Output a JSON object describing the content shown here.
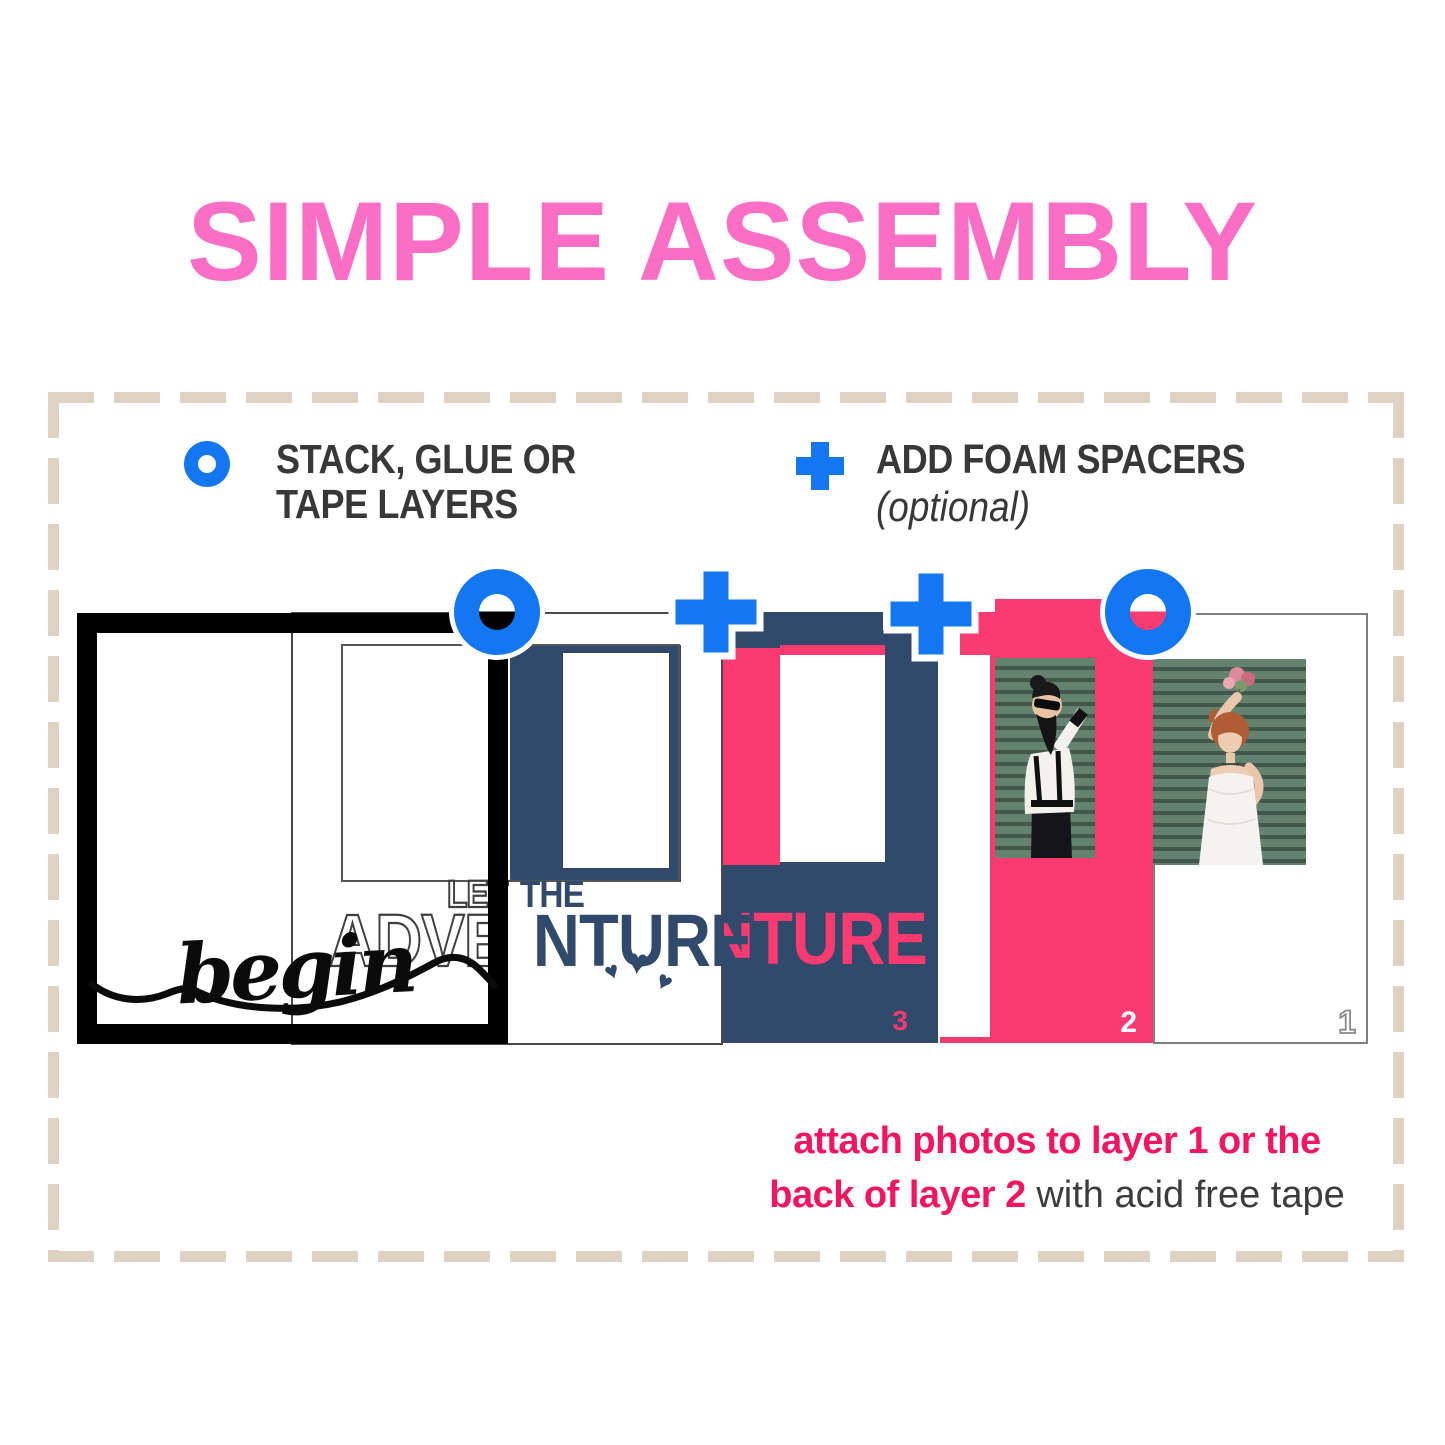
{
  "title": {
    "text": "SIMPLE ASSEMBLY"
  },
  "legend": {
    "stack_line1": "STACK, GLUE OR",
    "stack_line2": "TAPE LAYERS",
    "foam_label": "ADD FOAM SPACERS",
    "foam_note": "(optional)"
  },
  "layers": {
    "script_word": "begin",
    "small_outline": "LET",
    "small_filled": "THE",
    "big_outline": "ADVE",
    "big_filled": "NTURE",
    "big_pink": "NTURE",
    "num_layer3": "3",
    "num_layer2": "2",
    "num_layer1": "1"
  },
  "footer": {
    "line1": "attach photos to layer 1 or the",
    "line2_bold": "back of layer 2",
    "line2_rest": " with acid free tape"
  },
  "glyphs": {
    "heart": "♥"
  },
  "icons": {
    "legend_stack": "blue-ring-icon",
    "legend_foam": "blue-plus-icon",
    "step_ring": "blue-ring-icon",
    "step_plus": "blue-plus-icon"
  },
  "colors": {
    "title_pink": "#FA6EC6",
    "hot_pink": "#F93B72",
    "text_pink": "#F3155F",
    "navy": "#31496B",
    "icon_blue": "#1477F2",
    "dash_tan": "#DED2C3",
    "dark_text": "#383838",
    "photo_green_dark": "#42584A",
    "photo_green_light": "#64826D"
  }
}
